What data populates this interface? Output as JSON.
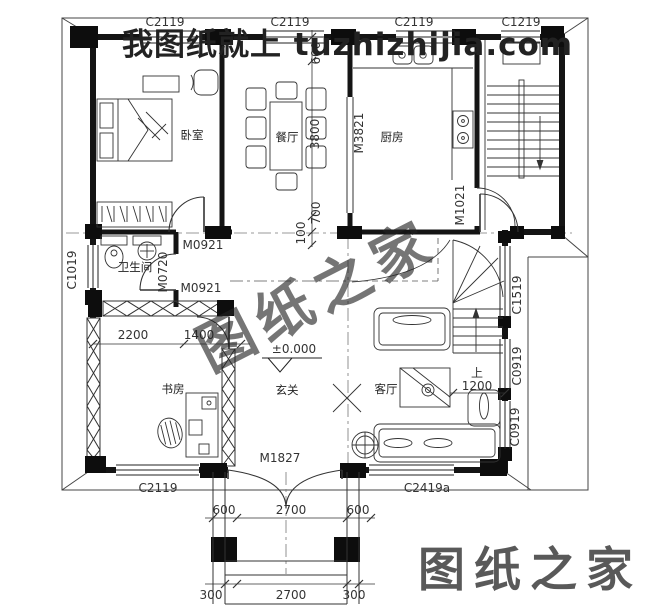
{
  "watermarks": {
    "top_text": "我图纸就上 tuzhizhijia.com",
    "top_color": "#e60012",
    "diagonal_text": "图纸之家",
    "diagonal_color": "#ee6e68",
    "corner_text": "图纸之家",
    "corner_color": "#f79c97"
  },
  "rooms": {
    "bedroom": "卧室",
    "dining": "餐厅",
    "kitchen": "厨房",
    "bathroom": "卫生间",
    "study": "书房",
    "hall": "玄关",
    "living": "客厅"
  },
  "windows": {
    "top1": "C2119",
    "top2": "C2119",
    "top3": "C2119",
    "top4": "C1219",
    "left1": "C1019",
    "right1": "C1519",
    "right2": "C0919",
    "right3": "C0919",
    "bottom1": "C2119",
    "bottom2": "C2419a"
  },
  "doors": {
    "bedroom": "M0921",
    "study": "M0921",
    "bathroom": "M0720",
    "kitchen": "M3821",
    "stair": "M1021",
    "entry": "M1827"
  },
  "dims": {
    "d600_top": "600",
    "d3800": "3800",
    "d700": "700",
    "d100": "100",
    "d2200": "2200",
    "d1400": "1400",
    "level": "±0.000",
    "up": "上",
    "d1200": "1200",
    "porch_left": "600",
    "porch_mid": "2700",
    "porch_right": "600",
    "base_left": "300",
    "base_mid": "2700",
    "base_right": "300"
  }
}
